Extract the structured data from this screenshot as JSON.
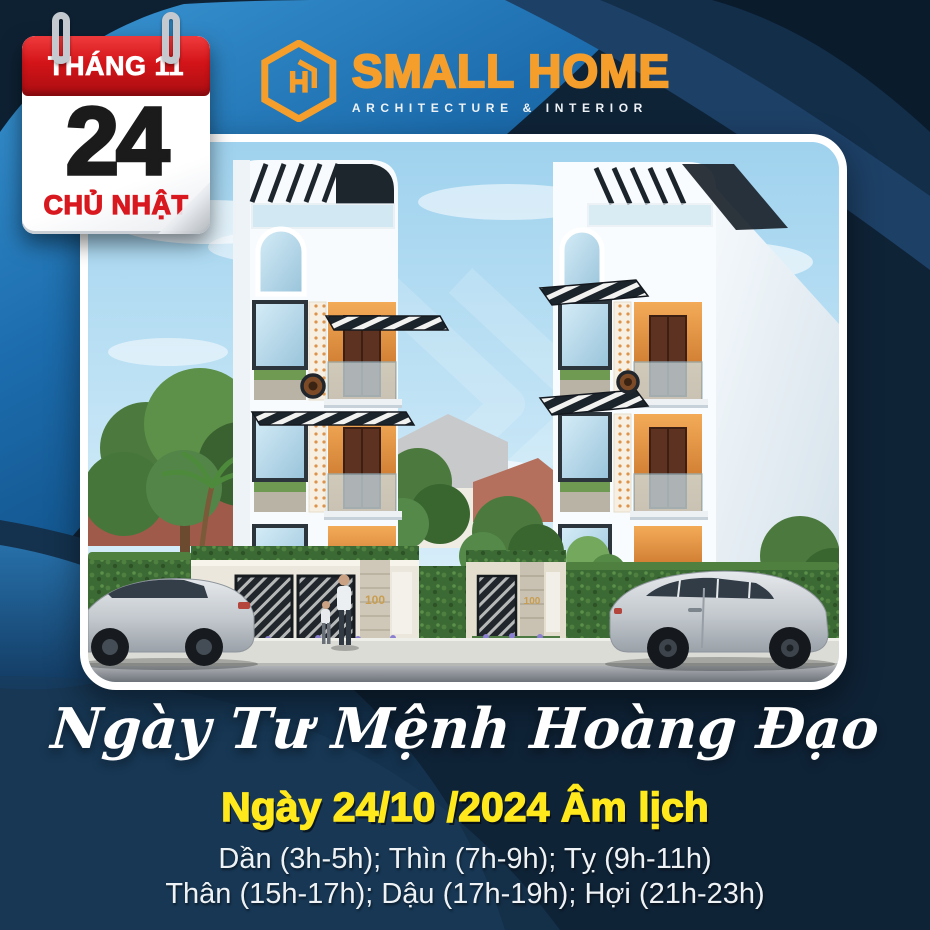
{
  "calendar": {
    "month": "THÁNG 11",
    "day": "24",
    "weekday": "CHỦ NHẬT"
  },
  "logo": {
    "name": "SMALL HOME",
    "tagline": "ARCHITECTURE & INTERIOR"
  },
  "photo": {
    "description": "two architectural renders of a narrow white modern townhouse facade, street with hedges, gates, pedestrians and silver cars",
    "house_number_left": "100",
    "house_number_right": "100"
  },
  "headline": {
    "text": "Ngày Tư Mệnh Hoàng Đạo"
  },
  "lunar_date": {
    "text": "Ngày 24/10 /2024 Âm lịch"
  },
  "zodiac_hours": {
    "line1": "Dần (3h-5h); Thìn (7h-9h); Tỵ (9h-11h)",
    "line2": "Thân (15h-17h); Dậu (17h-19h); Hợi (21h-23h)"
  },
  "colors": {
    "background_navy": "#0f2337",
    "bright_blue": "#2b84c4",
    "calendar_red": "#d31418",
    "calendar_day_black": "#1b1b1b",
    "logo_orange": "#f59e2b",
    "lunar_yellow": "#ffe81c",
    "text_white": "#eef2f4"
  },
  "icons": {
    "logo_mark": "hexagon-sh-monogram-icon",
    "calendar_rings": "binder-ring-icon",
    "watermark": "chevron-watermark-icon"
  }
}
